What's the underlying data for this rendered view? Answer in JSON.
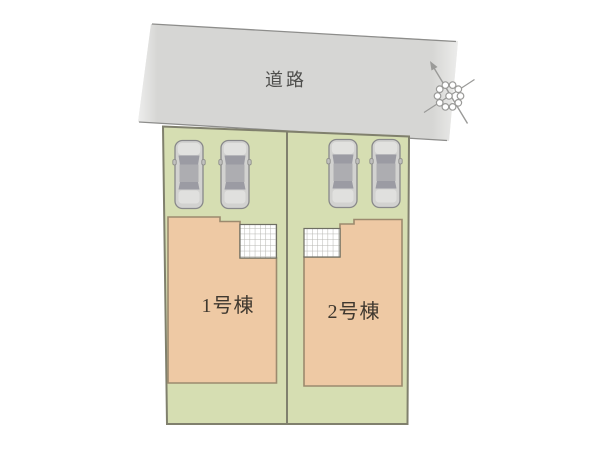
{
  "plan": {
    "road": {
      "label": "道路"
    },
    "buildings": [
      {
        "label": "1号棟"
      },
      {
        "label": "2号棟"
      }
    ],
    "parking": {
      "car_count": 4
    },
    "compass": {
      "direction": "north-upper-left"
    },
    "colors": {
      "road_fill": "#d5d5d3",
      "road_edge": "#8d8d8b",
      "lot_fill": "#d6deb2",
      "lot_border": "#80806d",
      "building_fill": "#eec9a4",
      "building_border": "#9c8a6e",
      "porch_grid_line": "#b5b5b0",
      "car_body": "#d2d2d0",
      "car_glass": "#9b9ba3",
      "compass_stroke": "#9a9a98",
      "label_color": "#3f382f"
    }
  }
}
